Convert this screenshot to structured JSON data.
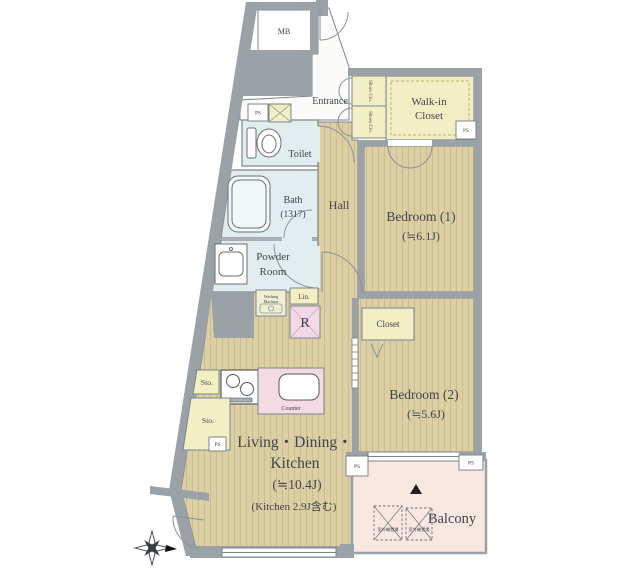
{
  "title": "Apartment floor plan",
  "labels": {
    "mb": "MB",
    "entrance": "Entrance",
    "walk_in_1": "Walk-in",
    "walk_in_2": "Closet",
    "shoes_closet": "Shoes Clo.",
    "toilet": "Toilet",
    "bath": "Bath",
    "bath_size": "(1317)",
    "hall": "Hall",
    "powder_1": "Powder",
    "powder_2": "Room",
    "washing_1": "Washing",
    "washing_2": "Machine",
    "linen": "Lin.",
    "fridge": "R",
    "closet": "Closet",
    "bedroom1": "Bedroom (1)",
    "bedroom1_size": "(≒6.1J)",
    "bedroom2": "Bedroom (2)",
    "bedroom2_size": "(≒5.6J)",
    "ldk_1": "Living・Dining・",
    "ldk_2": "Kitchen",
    "ldk_size": "(≒10.4J)",
    "ldk_note": "(Kitchen 2.9J含む)",
    "counter": "Counter",
    "sto": "Sto.",
    "ps": "PS",
    "balcony": "Balcony",
    "outdoor_unit": "室外機置場"
  },
  "colors": {
    "wall": "#9aa2a8",
    "partition": "#7d858c",
    "flooring": "#dbcfa3",
    "flooring_stripe": "#cabd92",
    "wet_area": "#e1edef",
    "storage_yellow": "#f3efc4",
    "washing_cell": "#eff0d3",
    "counter_pink": "#f4dae1",
    "fridge_pink": "#f2d9e5",
    "balcony_pink": "#f9e8e2",
    "text": "#3f454b"
  }
}
